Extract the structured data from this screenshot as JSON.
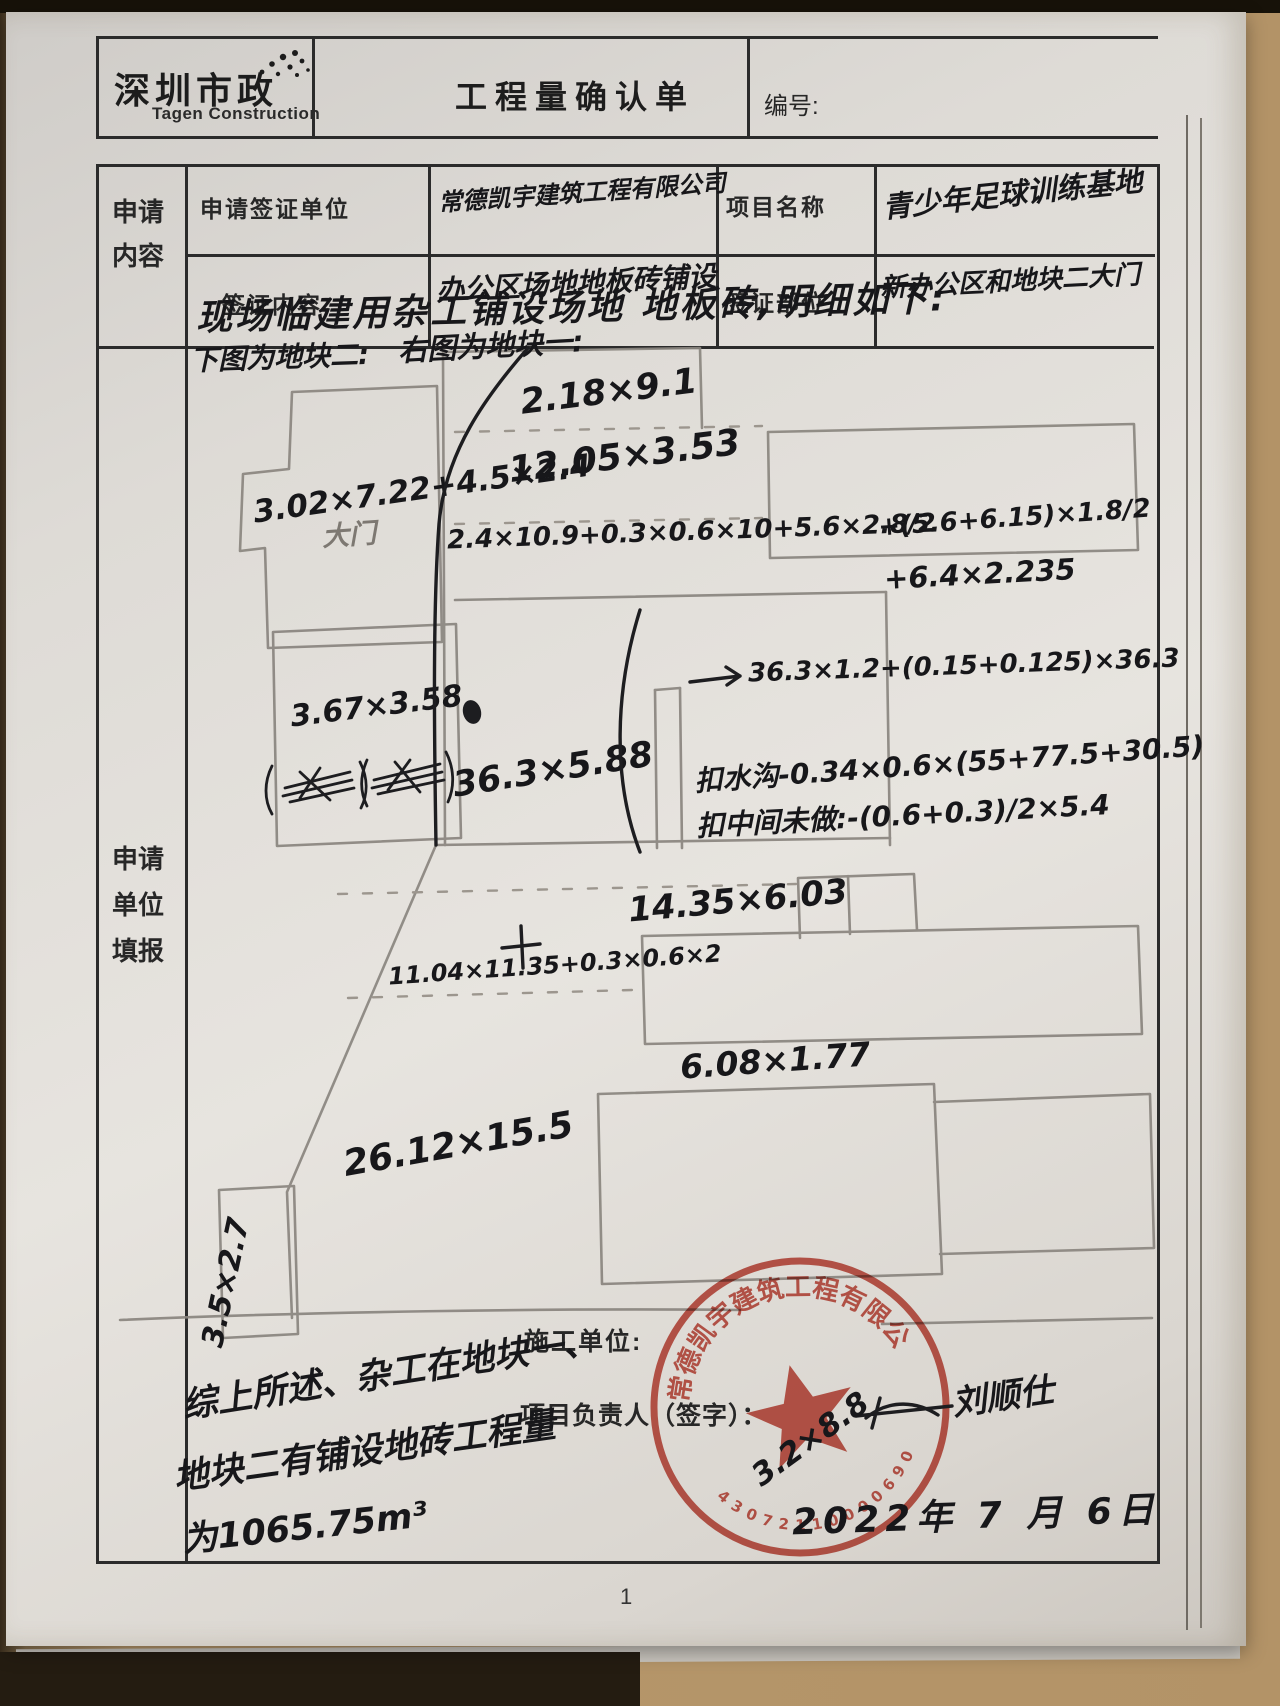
{
  "header": {
    "brand_cn": "深圳市政",
    "brand_en": "Tagen Construction",
    "title": "工程量确认单",
    "doc_no_label": "编号:"
  },
  "table": {
    "col_apply": "申请内容",
    "col_fill": "申请单位填报",
    "apply_unit_label": "申请签证单位",
    "apply_unit_value": "常德凯宇建筑工程有限公司",
    "project_label": "项目名称",
    "project_value": "青少年足球训练基地",
    "visa_content_label": "签证内容",
    "visa_content_value": "办公区场地地板砖铺设",
    "visa_part_label": "签证部位",
    "visa_part_value": "新办公区和地块二大门"
  },
  "sketch": {
    "intro": "现场临建用杂工铺设场地 地板砖,明细如下:",
    "left_caption": "下图为地块二:",
    "right_caption": "右图为地块一:",
    "gate": "大门",
    "m_block2_l": "3.02×7.22+4.5×2.4",
    "m_block2_rect": "3.67×3.58",
    "m_block2_strip": "36.3×5.88",
    "m_top": "2.18×9.1",
    "m_second": "12.05×3.53",
    "m_formula1": "2.4×10.9+0.3×0.6×10+5.6×2.8/2",
    "m_formula2": "+(5.6+6.15)×1.8/2",
    "m_formula3": "+6.4×2.235",
    "m_arrow": "36.3×1.2+(0.15+0.125)×36.3",
    "m_ditch": "扣水沟-0.34×0.6×(55+77.5+30.5)",
    "m_middle": "扣中间未做:-(0.6+0.3)/2×5.4",
    "m_1435": "14.35×6.03",
    "m_1104": "11.04×11.35+0.3×0.6×2",
    "m_608": "6.08×1.77",
    "m_2612": "26.12×15.5",
    "m_35": "3.5×2.7",
    "m_32": "3.2×8.8"
  },
  "footer": {
    "builder_label": "施工单位:",
    "manager_label": "项目负责人（签字）：",
    "signature": "刘顺仕",
    "summary1": "综上所述、杂工在地块一、",
    "summary2": "地块二有铺设地砖工程量",
    "summary3": "为1065.75m³",
    "date": "2022年 7 月 6日",
    "stamp_company": "常德凯宇建筑工程有限公司",
    "stamp_number": "43072110000690"
  },
  "page_number": "1"
}
